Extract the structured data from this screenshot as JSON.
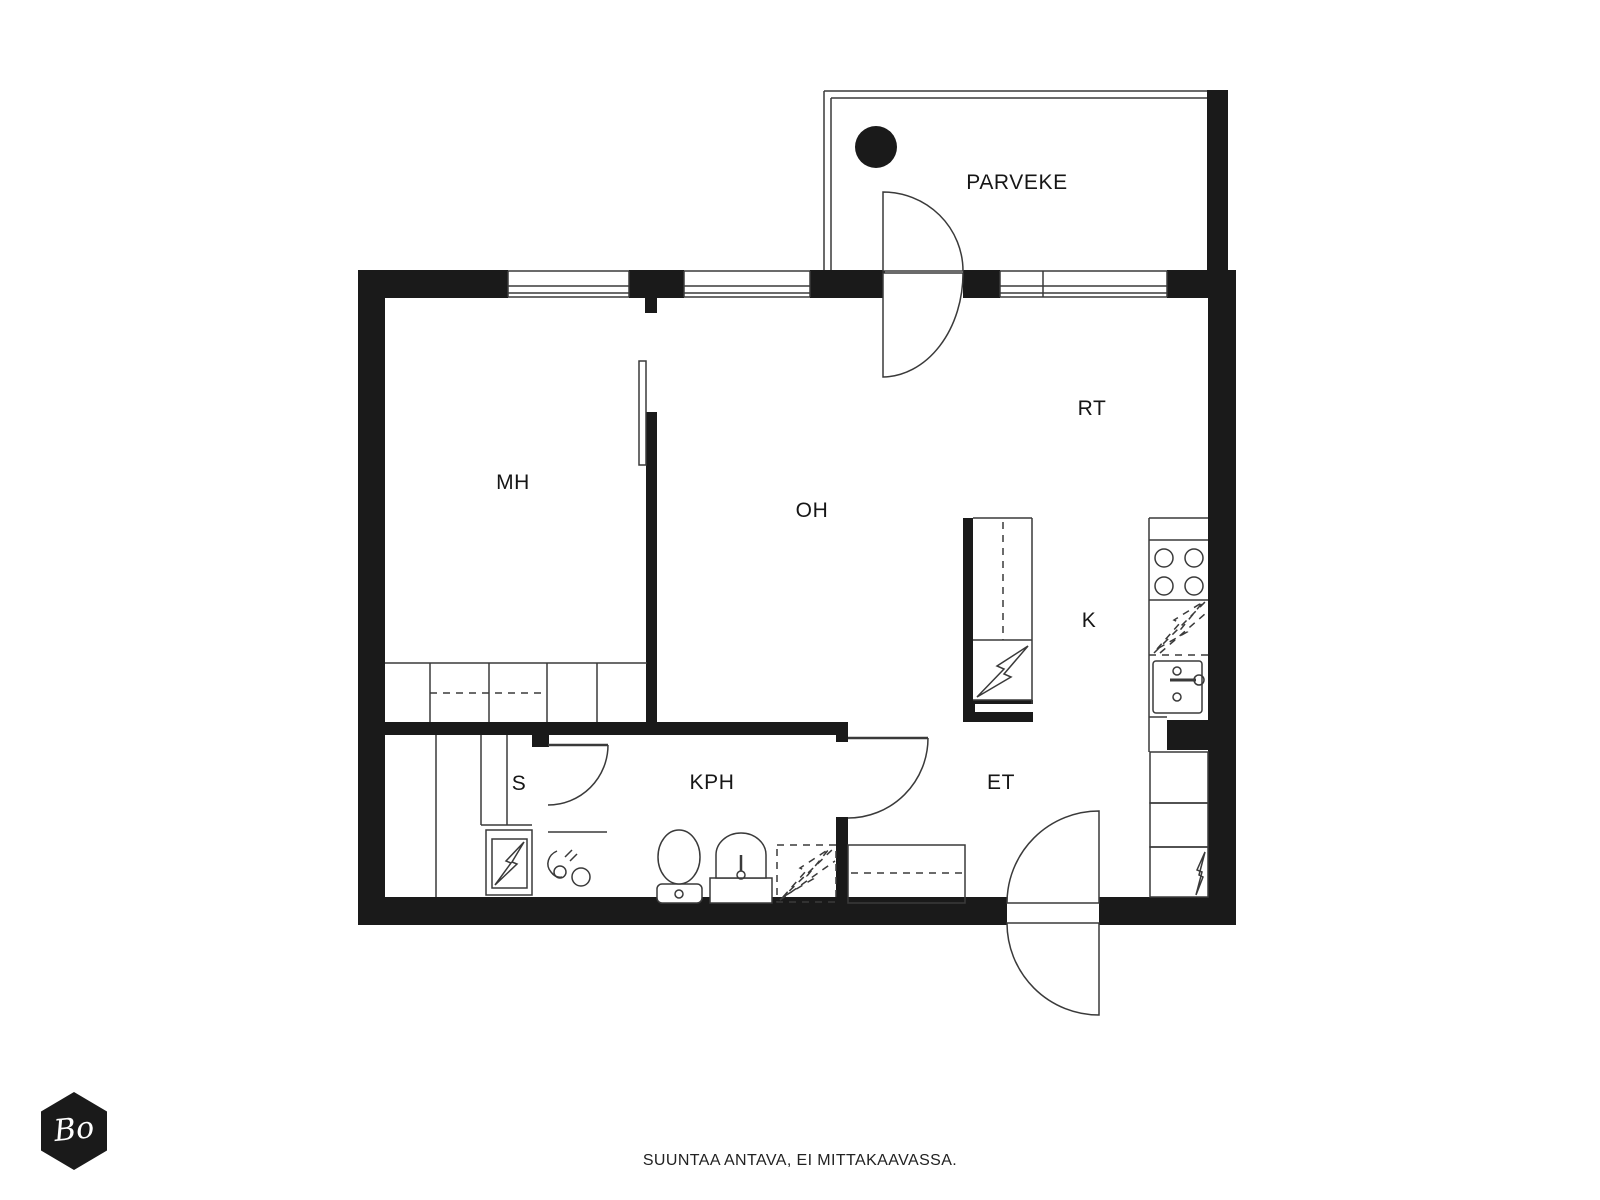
{
  "rooms": {
    "parveke": "PARVEKE",
    "mh": "MH",
    "oh": "OH",
    "rt": "RT",
    "k": "K",
    "et": "ET",
    "kph": "KPH",
    "s": "S"
  },
  "footer": {
    "note": "SUUNTAA ANTAVA, EI MITTAKAAVASSA."
  },
  "logo": {
    "text": "Bo"
  },
  "colors": {
    "wall": "#1a1a1a",
    "line": "#3a3a3a",
    "background": "#ffffff",
    "label_text": "#161616"
  },
  "icons": {
    "balcony-table-icon": "filled black circle",
    "door-swing-icon": "quarter-circle arc",
    "stove-icon": "four burner circles",
    "sink-icon": "cabinet with faucet circle",
    "lightning-bolt-icon": "zigzag bolt outline (electrical appliance)",
    "dashed-lightning-bolt-icon": "dashed zigzag bolt (appliance reservation)",
    "toilet-icon": "oval bowl with cistern",
    "washbasin-icon": "arched basin on pedestal",
    "shower-mixer-icon": "hook pipe with two knobs",
    "logo-hexagon-icon": "black hexagon badge"
  }
}
